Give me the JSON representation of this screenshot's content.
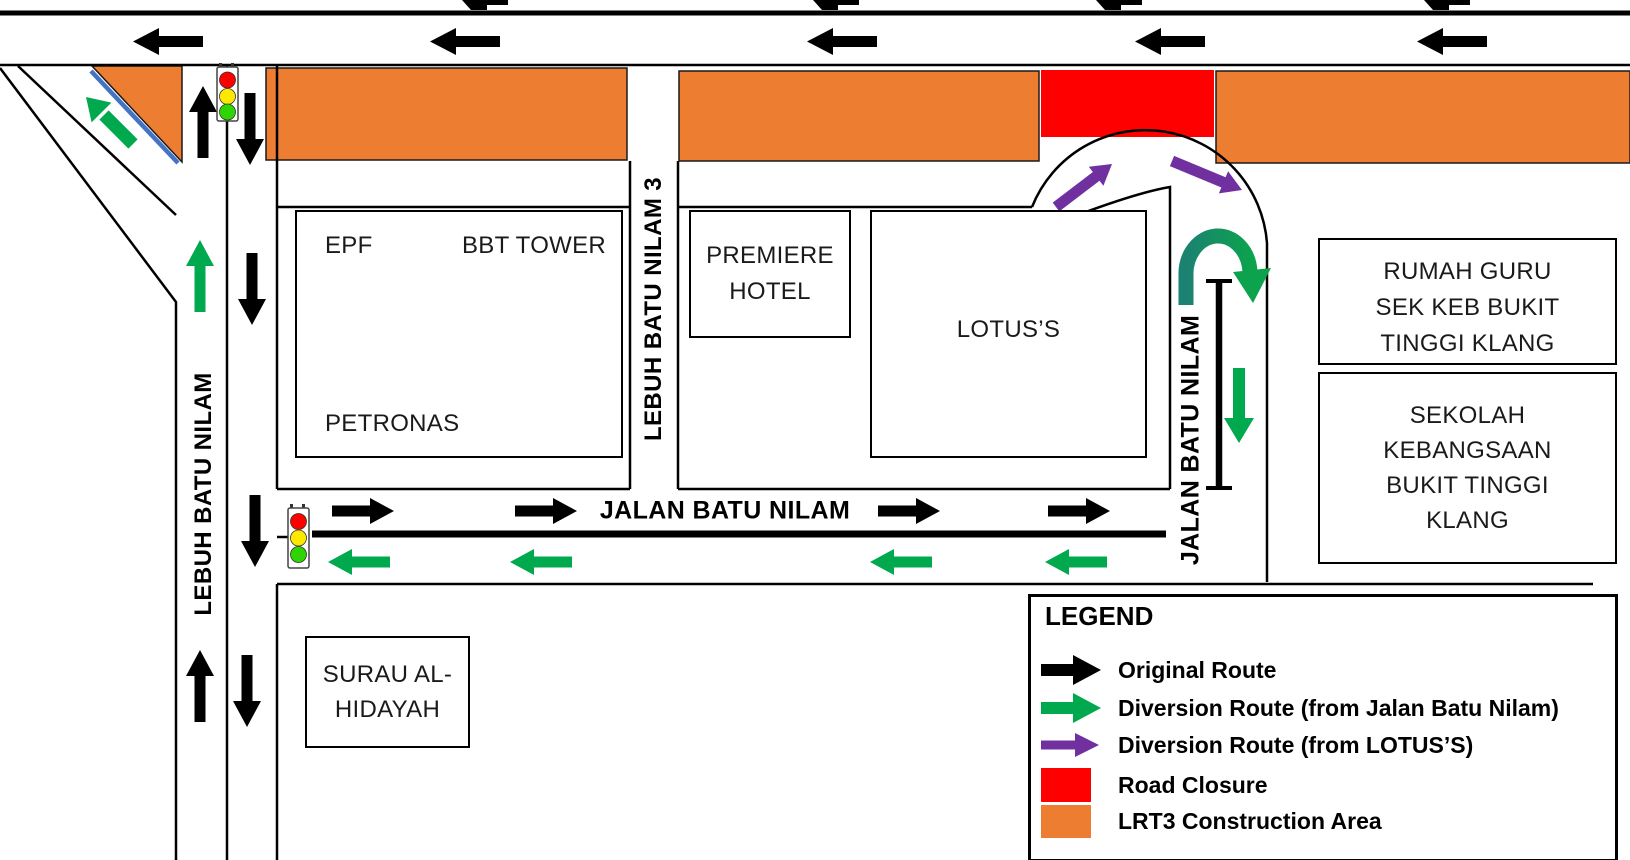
{
  "colors": {
    "orange": "#ED7D31",
    "red": "#FF0000",
    "green": "#00A94E",
    "purple": "#7030A0",
    "blue": "#4472C4",
    "uturn_dark": "#1B8272",
    "uturn_light": "#0CA24E",
    "signal_red": "#FF0000",
    "signal_yellow": "#FFE800",
    "signal_green": "#2FD500"
  },
  "roads": {
    "lebuh_batu_nilam": "LEBUH BATU NILAM",
    "lebuh_batu_nilam_3": "LEBUH BATU NILAM 3",
    "jalan_batu_nilam_h": "JALAN BATU NILAM",
    "jalan_batu_nilam_v": "JALAN BATU NILAM"
  },
  "buildings": {
    "main": {
      "epf": "EPF",
      "bbt_tower": "BBT TOWER",
      "petronas": "PETRONAS"
    },
    "premiere": {
      "lines": [
        "PREMIERE",
        "HOTEL"
      ]
    },
    "lotus": {
      "label": "LOTUS’S"
    },
    "surau": {
      "lines": [
        "SURAU AL-",
        "HIDAYAH"
      ]
    },
    "rumah_guru": {
      "lines": [
        "RUMAH GURU",
        "SEK KEB BUKIT",
        "TINGGI KLANG"
      ]
    },
    "sekolah": {
      "lines": [
        "SEKOLAH",
        "KEBANGSAAN",
        "BUKIT TINGGI",
        "KLANG"
      ]
    }
  },
  "legend": {
    "title": "LEGEND",
    "items": [
      {
        "key": "original-route",
        "swatch": "black-arrow-icon",
        "label": "Original Route"
      },
      {
        "key": "diversion-jalan",
        "swatch": "green-arrow-icon",
        "label": "Diversion Route (from Jalan Batu Nilam)"
      },
      {
        "key": "diversion-lotus",
        "swatch": "purple-arrow-icon",
        "label": "Diversion Route (from LOTUS’S)"
      },
      {
        "key": "road-closure",
        "swatch": "red-square-icon",
        "label": "Road Closure"
      },
      {
        "key": "lrt3-construction",
        "swatch": "orange-square-icon",
        "label": "LRT3 Construction Area"
      }
    ]
  }
}
